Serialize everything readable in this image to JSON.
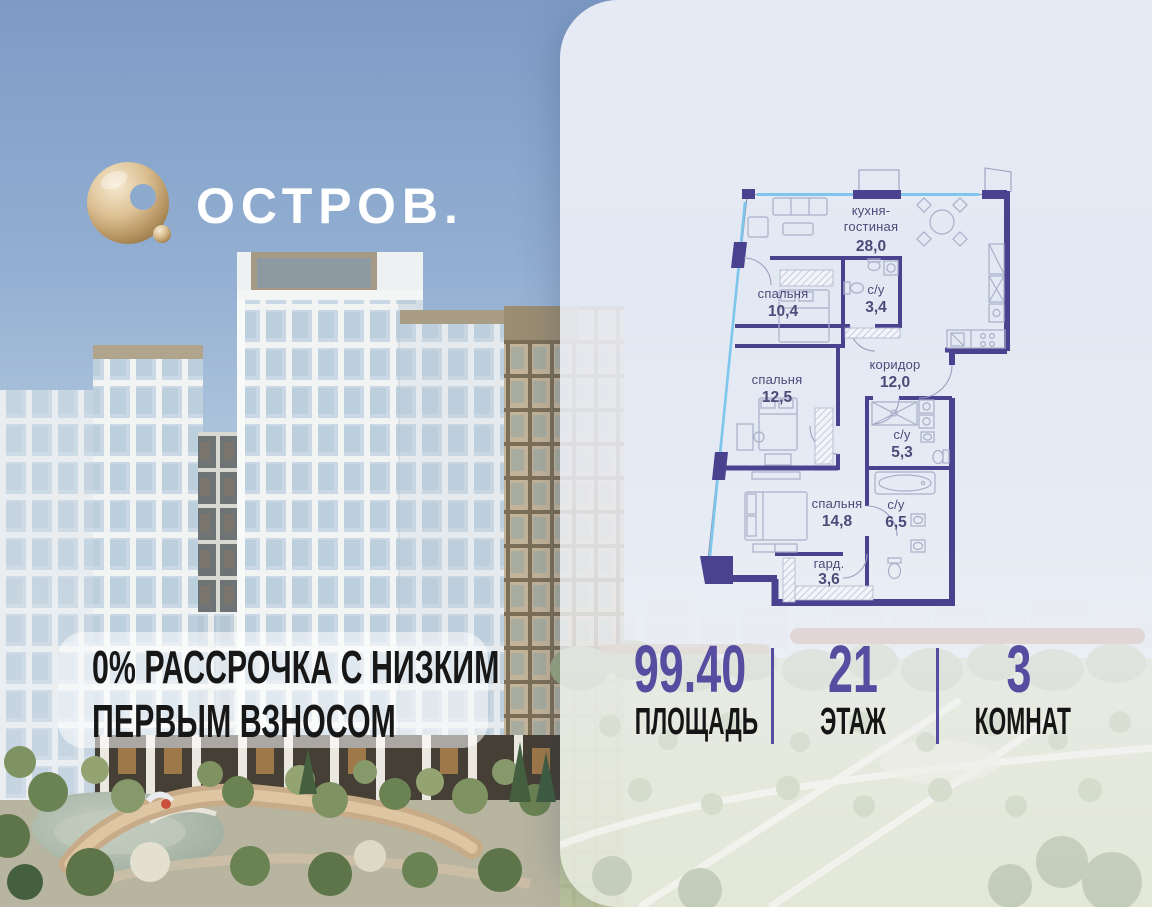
{
  "brand": {
    "name": "ОСТРОВ."
  },
  "promo": {
    "line1": "0% РАССРОЧКА С НИЗКИМ",
    "line2": "ПЕРВЫМ ВЗНОСОМ"
  },
  "floorplan": {
    "rooms": [
      {
        "name": "кухня-",
        "name2": "гостиная",
        "area": "28,0"
      },
      {
        "name": "спальня",
        "area": "10,4"
      },
      {
        "name": "с/у",
        "area": "3,4"
      },
      {
        "name": "коридор",
        "area": "12,0"
      },
      {
        "name": "спальня",
        "area": "12,5"
      },
      {
        "name": "с/у",
        "area": "5,3"
      },
      {
        "name": "спальня",
        "area": "14,8"
      },
      {
        "name": "с/у",
        "area": "6,5"
      },
      {
        "name": "гард.",
        "area": "3,6"
      }
    ]
  },
  "stats": {
    "items": [
      {
        "value": "99.40",
        "label": "ПЛОЩАДЬ"
      },
      {
        "value": "21",
        "label": "ЭТАЖ"
      },
      {
        "value": "3",
        "label": "КОМНАТ"
      }
    ]
  },
  "colors": {
    "accent": "#574da0",
    "plan_wall": "#4a428f",
    "plan_window": "#7ec6ec",
    "panel": "#edeff6",
    "logo_gold": "#c9a87c"
  }
}
